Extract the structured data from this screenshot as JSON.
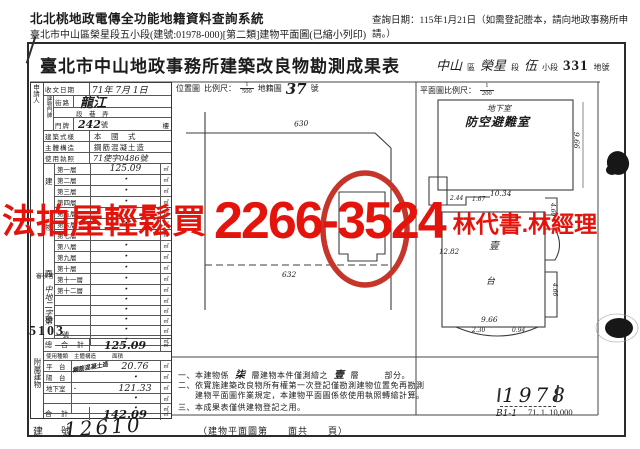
{
  "header": {
    "system_title": "北北桃地政電傳全功能地籍資料查詢系統",
    "query_date": "查詢日期：115年1月21日（如需登記謄本，請向地政事務所申請。）",
    "subtitle": "臺北市中山區榮星段五小段(建號:01978-000)[第二類]建物平面圖(已縮小列印)"
  },
  "title": {
    "main": "臺北市中山地政事務所建築改良物勘測成果表",
    "area": [
      {
        "hand": "中山",
        "print": "區"
      },
      {
        "hand": "榮星",
        "print": "段"
      },
      {
        "hand": "伍",
        "print": "小段"
      },
      {
        "hand": "331",
        "print": "地號"
      }
    ]
  },
  "form": {
    "applicant_label": "申請人",
    "receive": {
      "label": "收文日期",
      "value": "71年 7月 1日"
    },
    "door_block_label": "建物門牌",
    "street": {
      "label": "街路",
      "value": "龍江"
    },
    "lane": {
      "label": "段巷弄",
      "value": "段　巷　弄"
    },
    "door": {
      "label": "門牌",
      "value": "242",
      "suffix": "號",
      "suffix2": "樓"
    },
    "style": {
      "label": "建築式樣",
      "value": "本　國　式"
    },
    "structure": {
      "label": "主體構造",
      "value": "鋼筋混凝土造"
    },
    "license": {
      "label": "使用執照",
      "value": "71使字0486號"
    },
    "area_block_label": "建物面積",
    "unit": "㎡",
    "floors": [
      {
        "label": "第一層",
        "value": "125.09"
      },
      {
        "label": "第二層",
        "value": "・"
      },
      {
        "label": "第三層",
        "value": "・"
      },
      {
        "label": "第四層",
        "value": "・"
      },
      {
        "label": "第五層",
        "value": "・"
      },
      {
        "label": "第六層",
        "value": "・"
      },
      {
        "label": "第七層",
        "value": "・"
      },
      {
        "label": "第八層",
        "value": "・"
      },
      {
        "label": "第九層",
        "value": "・"
      },
      {
        "label": "第十層",
        "value": "・"
      },
      {
        "label": "第十一層",
        "value": "・"
      },
      {
        "label": "第十二層",
        "value": "・"
      },
      {
        "label": "",
        "value": "・"
      },
      {
        "label": "",
        "value": "・"
      },
      {
        "label": "",
        "value": "・"
      },
      {
        "label": "",
        "value": "・"
      },
      {
        "label": "",
        "value": "・"
      }
    ],
    "total": {
      "label": "總　合　計",
      "value": "125.09"
    },
    "attached": {
      "block_label": "附屬建物",
      "header": [
        "使用種類",
        "主體構造",
        "面積"
      ],
      "rows": [
        {
          "use": "平　台",
          "structure": "鋼筋混凝土造",
          "area": "20.76"
        },
        {
          "use": "陽　台",
          "structure": "",
          "area": "・"
        },
        {
          "use": "地下室",
          "structure": "・",
          "area": "121.33"
        },
        {
          "use": "",
          "structure": "",
          "area": "・"
        },
        {
          "use": "",
          "structure": "",
          "area": "・"
        }
      ],
      "total": {
        "label": "合　計",
        "value": "142.09"
      }
    },
    "reviewer_label": "審核者",
    "case_prefix": "中地二字第",
    "case_no": "5103",
    "case_suffix": "號",
    "building_no": {
      "label": "建　號",
      "value": "12610"
    },
    "page_note": "（建物平面圖第　　面共　　頁）"
  },
  "location_map": {
    "label": "位置圖",
    "scale_label": "比例尺：",
    "scale_num": "1",
    "scale_den": "500",
    "cadastral_label": "地籍圖",
    "map_no": "37",
    "map_no_unit": "號",
    "dim_top": "630",
    "dim_bottom": "632"
  },
  "floor_plan": {
    "scale_label": "平面圖比例尺：",
    "scale_num": "1",
    "scale_den": "200",
    "basement_small": "地下室",
    "basement_big": "防空避難室",
    "dims": {
      "right": "9.66",
      "bottom": "10.34",
      "a": "2.44",
      "b": "1.67",
      "left": "12.82",
      "floor": "壹",
      "inner": "台",
      "w": "9.66",
      "w2": "2.30",
      "w3": "0.94",
      "p1": "4.60",
      "p2": "4.66"
    }
  },
  "notes": {
    "n1_pre": "一、本建物係",
    "n1_hand1": "柒",
    "n1_mid": "層建物本件僅測繪之",
    "n1_hand2": "壹",
    "n1_post": "層　　　部分。",
    "n2": "二、依實施建築改良物所有權第一次登記僅勘測建物位置免再勘測\n　　建物平面圖作業規定，本建物平面圖係依使用執照轉繪計算。",
    "n3": "三、本成果表僅供建物登記之用。"
  },
  "stamps": {
    "plan_no": "1978",
    "plan_code": "B1-1",
    "print_code": "71. 1. 10,000"
  },
  "overlay": {
    "ad_left": "法拍屋輕鬆買",
    "ad_phone": "2266-3524",
    "ad_right": "林代書.林經理",
    "red": "#e4140c"
  }
}
